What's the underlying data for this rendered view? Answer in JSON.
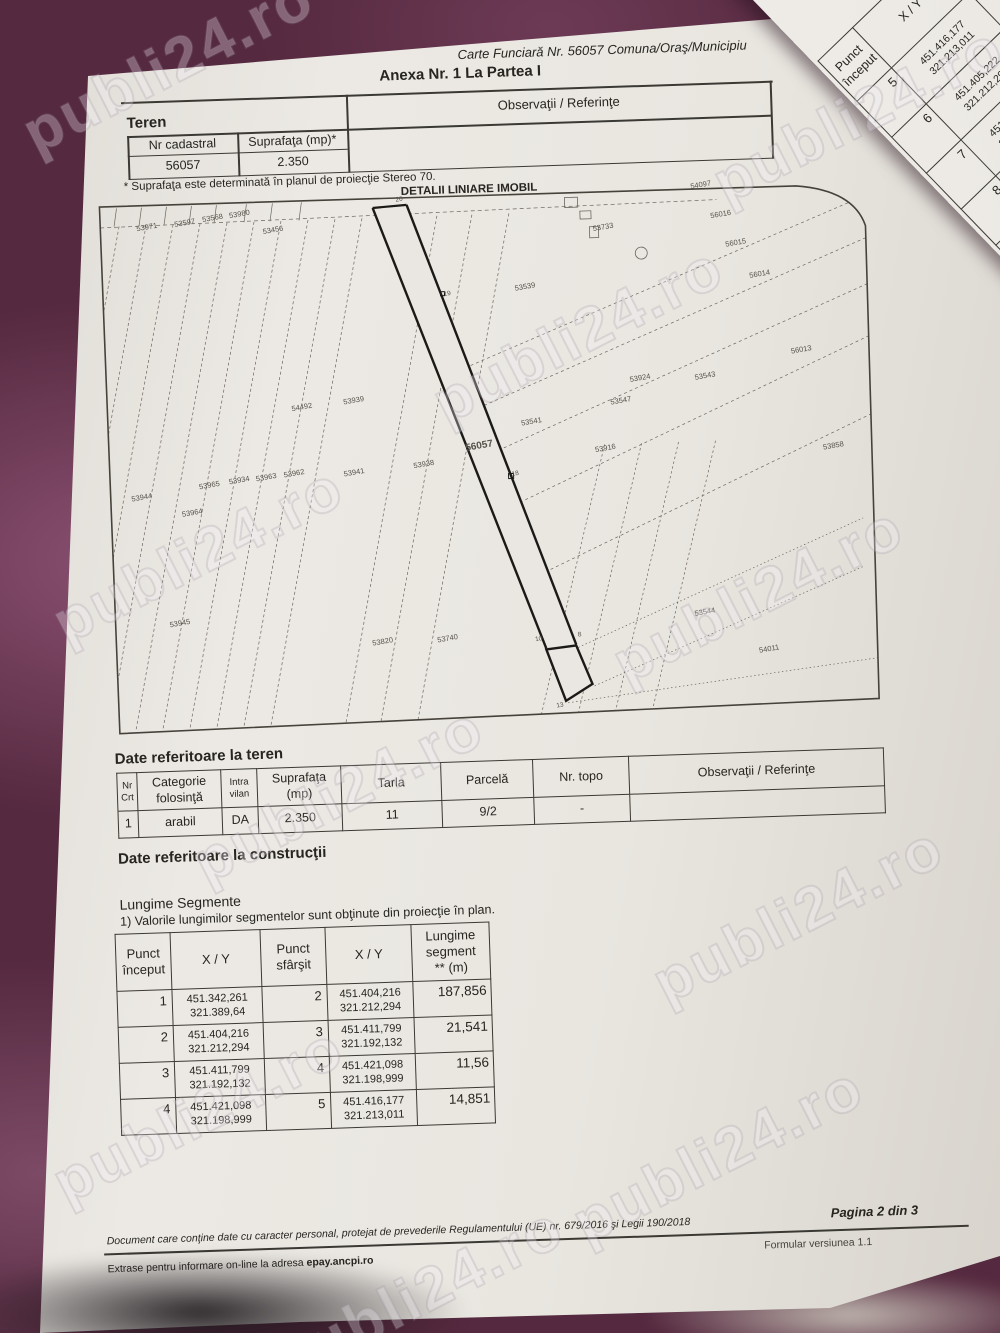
{
  "colors": {
    "background_fabric": "#55293f",
    "paper": "#e9e6e0",
    "ink": "#26251f"
  },
  "watermark": {
    "text": "publi24.ro"
  },
  "page_header": {
    "carte_funciara": "Carte Funciară Nr. 56057 Comuna/Oraş/Municipiu",
    "anexa_title": "Anexa Nr. 1 La Partea I"
  },
  "teren_section": {
    "heading": "Teren",
    "obs_header": "Observaţii / Referinţe",
    "col_nr_cadastral": "Nr cadastral",
    "col_suprafata": "Suprafaţa (mp)*",
    "nr_cadastral": "56057",
    "suprafata": "2.350",
    "footnote": "* Suprafaţa este determinată în planul de proiecţie Stereo 70."
  },
  "map": {
    "title": "DETALII LINIARE IMOBIL",
    "main_parcel": "56057",
    "parcel_labels": [
      {
        "t": "53971",
        "x": 50,
        "y": 40
      },
      {
        "t": "53597",
        "x": 88,
        "y": 37
      },
      {
        "t": "53568",
        "x": 116,
        "y": 33
      },
      {
        "t": "53980",
        "x": 143,
        "y": 30
      },
      {
        "t": "53456",
        "x": 176,
        "y": 47
      },
      {
        "t": "53733",
        "x": 506,
        "y": 55
      },
      {
        "t": "54097",
        "x": 605,
        "y": 16
      },
      {
        "t": "56016",
        "x": 624,
        "y": 46
      },
      {
        "t": "56015",
        "x": 638,
        "y": 75
      },
      {
        "t": "56014",
        "x": 661,
        "y": 107
      },
      {
        "t": "56013",
        "x": 700,
        "y": 184
      },
      {
        "t": "53539",
        "x": 426,
        "y": 112
      },
      {
        "t": "54492",
        "x": 199,
        "y": 225
      },
      {
        "t": "53939",
        "x": 251,
        "y": 220
      },
      {
        "t": "53924",
        "x": 538,
        "y": 207
      },
      {
        "t": "53543",
        "x": 603,
        "y": 207
      },
      {
        "t": "53547",
        "x": 518,
        "y": 229
      },
      {
        "t": "53541",
        "x": 428,
        "y": 247
      },
      {
        "t": "53916",
        "x": 501,
        "y": 276
      },
      {
        "t": "53858",
        "x": 729,
        "y": 281
      },
      {
        "t": "53938",
        "x": 319,
        "y": 286
      },
      {
        "t": "56057",
        "x": 375,
        "y": 270,
        "main": true
      },
      {
        "t": "53944",
        "x": 36,
        "y": 310
      },
      {
        "t": "53965",
        "x": 104,
        "y": 300
      },
      {
        "t": "53934",
        "x": 134,
        "y": 296
      },
      {
        "t": "53963",
        "x": 161,
        "y": 294
      },
      {
        "t": "53962",
        "x": 189,
        "y": 291
      },
      {
        "t": "53941",
        "x": 249,
        "y": 292
      },
      {
        "t": "53964",
        "x": 86,
        "y": 327
      },
      {
        "t": "53945",
        "x": 70,
        "y": 437
      },
      {
        "t": "53820",
        "x": 272,
        "y": 462
      },
      {
        "t": "53740",
        "x": 337,
        "y": 461
      },
      {
        "t": "53544",
        "x": 595,
        "y": 443
      },
      {
        "t": "54011",
        "x": 658,
        "y": 482
      }
    ],
    "point_labels": [
      {
        "t": "20",
        "x": 303,
        "y": 20
      },
      {
        "t": "19",
        "x": 348,
        "y": 116
      },
      {
        "t": "18",
        "x": 410,
        "y": 298
      },
      {
        "t": "10",
        "x": 428,
        "y": 464
      },
      {
        "t": "8",
        "x": 469,
        "y": 461
      },
      {
        "t": "13",
        "x": 447,
        "y": 531
      }
    ]
  },
  "date_teren": {
    "heading": "Date referitoare la teren",
    "headers": [
      [
        "Nr",
        "Crt"
      ],
      [
        "Categorie",
        "folosinţă"
      ],
      [
        "Intra",
        "vilan"
      ],
      [
        "Suprafaţa",
        "(mp)"
      ],
      [
        "Tarla"
      ],
      [
        "Parcelă"
      ],
      [
        "Nr. topo"
      ],
      [
        "Observaţii / Referinţe"
      ]
    ],
    "row": [
      "1",
      "arabil",
      "DA",
      "2.350",
      "11",
      "9/2",
      "-",
      ""
    ]
  },
  "constructii": {
    "heading": "Date referitoare la construcţii"
  },
  "segmente": {
    "heading": "Lungime Segmente",
    "note": "1) Valorile lungimilor segmentelor sunt obţinute din proiecţie în plan.",
    "headers": [
      [
        "Punct",
        "început"
      ],
      [
        "X / Y"
      ],
      [
        "Punct",
        "sfârşit"
      ],
      [
        "X / Y"
      ],
      [
        "Lungime",
        "segment",
        "** (m)"
      ]
    ],
    "rows": [
      {
        "s": "1",
        "xy1": [
          "451.342,261",
          "321.389,64"
        ],
        "e": "2",
        "xy2": [
          "451.404,216",
          "321.212,294"
        ],
        "len": "187,856"
      },
      {
        "s": "2",
        "xy1": [
          "451.404,216",
          "321.212,294"
        ],
        "e": "3",
        "xy2": [
          "451.411,799",
          "321.192,132"
        ],
        "len": "21,541"
      },
      {
        "s": "3",
        "xy1": [
          "451.411,799",
          "321.192,132"
        ],
        "e": "4",
        "xy2": [
          "451.421,098",
          "321.198,999"
        ],
        "len": "11,56"
      },
      {
        "s": "4",
        "xy1": [
          "451.421,098",
          "321.198,999"
        ],
        "e": "5",
        "xy2": [
          "451.416,177",
          "321.213,011"
        ],
        "len": "14,851"
      }
    ]
  },
  "sheet2": {
    "headers": [
      [
        "Punct",
        "început"
      ],
      [
        "X / Y"
      ],
      [
        "Punct",
        "sfârşit"
      ],
      [
        "X / Y"
      ],
      [
        "Lungime",
        "segment",
        "** (m)"
      ]
    ],
    "rows": [
      {
        "s": "5",
        "xy1": [
          "451.416,177",
          "321.213,011"
        ],
        "e": "6",
        "xy2": [
          "451.405,222",
          "321.212,296"
        ],
        "len": ""
      },
      {
        "s": "6",
        "xy1": [
          "451.405,222",
          "321.212,296"
        ],
        "e": "7",
        "xy2": [
          "451.404,222",
          "321.212,296"
        ],
        "len": ""
      },
      {
        "s": "7",
        "xy1": [
          "451.404,222",
          "321.212,296"
        ],
        "e": "8",
        "xy2": [
          "451.404,222",
          "321.213,296"
        ],
        "len": ""
      },
      {
        "s": "8",
        "xy1": [
          "451.404,222",
          "321.213,296"
        ],
        "e": "9",
        "xy2": [
          "451.405,222",
          "321.213,296"
        ],
        "len": ""
      },
      {
        "s": "9",
        "xy1": [
          "451.405,222",
          "321.213,296"
        ],
        "e": "10",
        "xy2": [
          "451.405,322",
          "321.213,296"
        ],
        "len": ""
      },
      {
        "s": "10",
        "xy1": [
          "451.405,322",
          "321.213,296"
        ],
        "e": "11",
        "xy2": [
          "",
          ""
        ],
        "len": ""
      },
      {
        "s": "11",
        "xy1": [
          "",
          ""
        ],
        "e": "",
        "xy2": [
          "",
          ""
        ],
        "len": ""
      }
    ]
  },
  "footer": {
    "privacy": "Document care conţine date cu caracter personal, protejat de prevederile Regulamentului (UE) nr. 679/2016 şi Legii 190/2018",
    "page": "Pagina 2 din 3",
    "formular": "Formular versiunea 1.1",
    "extras_prefix": "Extrase pentru informare on-line la adresa ",
    "extras_link": "epay.ancpi.ro"
  }
}
